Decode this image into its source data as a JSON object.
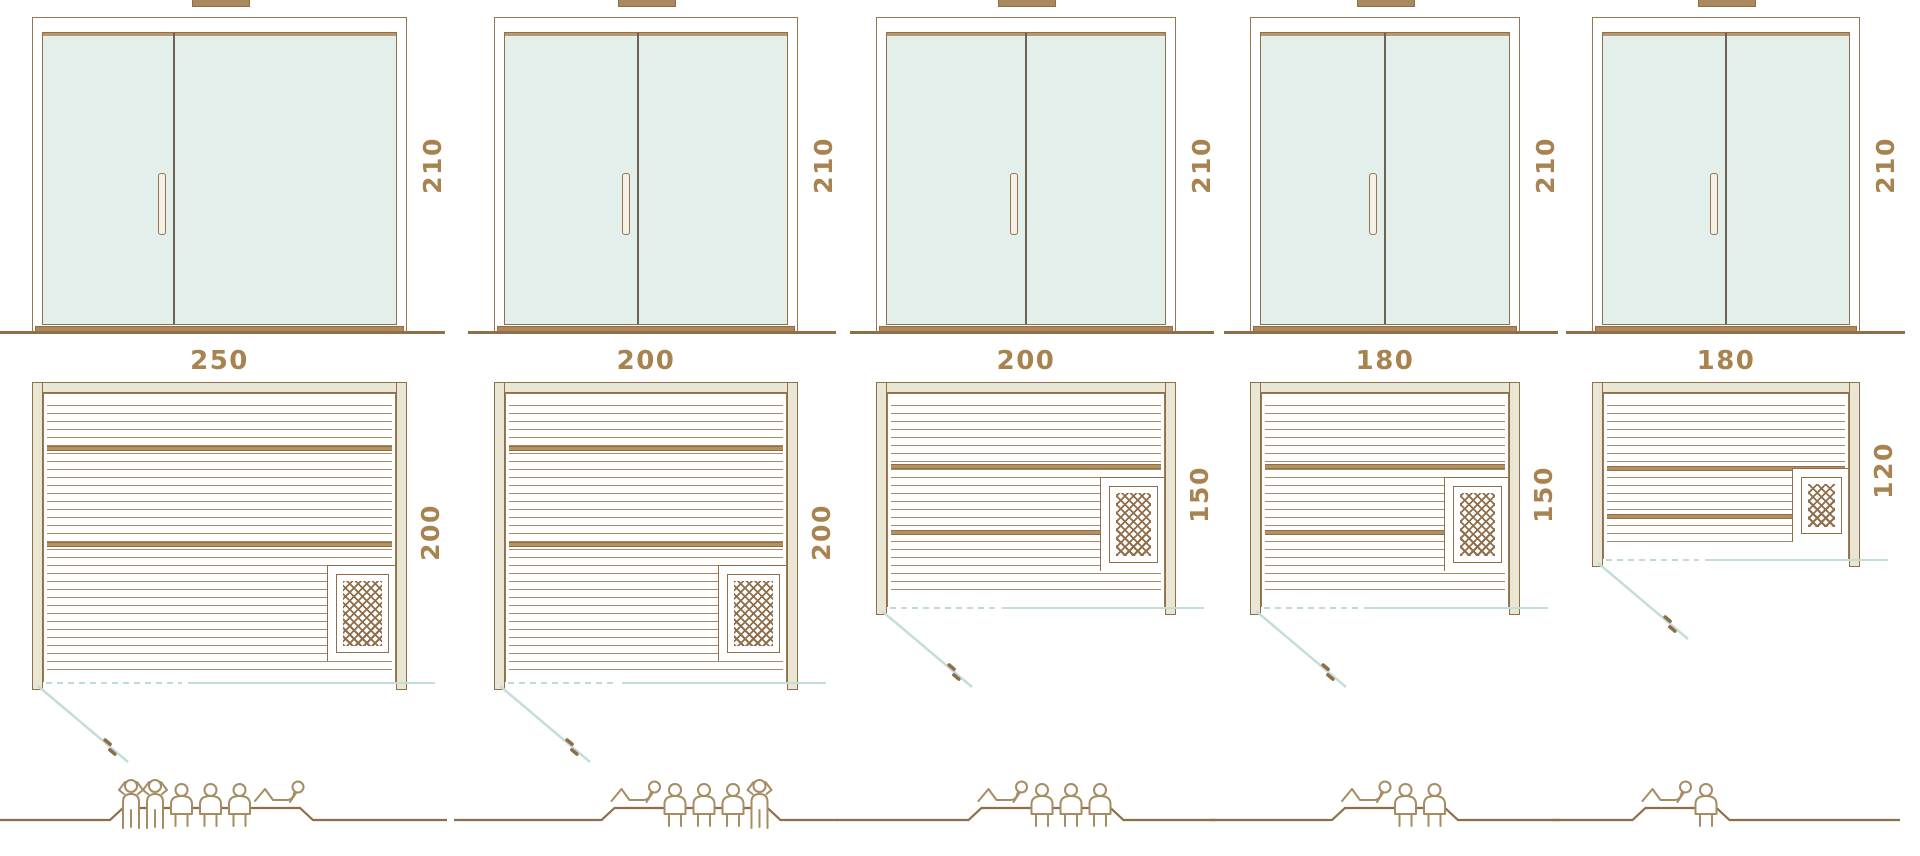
{
  "diagram_title": "",
  "colors": {
    "line_brown": "#8f6e49",
    "slat_brown": "#aa8a61",
    "wall_beige": "#e9e6d3",
    "glass_mint": "#e2efeb",
    "glass_header": "#b59a70",
    "sill_brown": "#ab8759",
    "label_text": "#a8824f",
    "swing_teal": "#c3ded8",
    "figure_tan": "#a58c63"
  },
  "units": [
    {
      "name": "sauna-250x200",
      "door": {
        "height_label": "210"
      },
      "plan": {
        "width_label": "250",
        "depth_label": "200"
      },
      "capacity": {
        "total": 6,
        "figures": [
          "standing",
          "standing",
          "sitting",
          "sitting",
          "sitting",
          "lying"
        ]
      }
    },
    {
      "name": "sauna-200x200",
      "door": {
        "height_label": "210"
      },
      "plan": {
        "width_label": "200",
        "depth_label": "200"
      },
      "capacity": {
        "total": 5,
        "figures": [
          "lying",
          "sitting",
          "sitting",
          "sitting",
          "standing"
        ]
      }
    },
    {
      "name": "sauna-200x150",
      "door": {
        "height_label": "210"
      },
      "plan": {
        "width_label": "200",
        "depth_label": "150"
      },
      "capacity": {
        "total": 4,
        "figures": [
          "lying",
          "sitting",
          "sitting",
          "sitting"
        ]
      }
    },
    {
      "name": "sauna-180x150",
      "door": {
        "height_label": "210"
      },
      "plan": {
        "width_label": "180",
        "depth_label": "150"
      },
      "capacity": {
        "total": 3,
        "figures": [
          "lying",
          "sitting",
          "sitting"
        ]
      }
    },
    {
      "name": "sauna-180x120",
      "door": {
        "height_label": "210"
      },
      "plan": {
        "width_label": "180",
        "depth_label": "120"
      },
      "capacity": {
        "total": 2,
        "figures": [
          "lying",
          "sitting"
        ]
      }
    }
  ]
}
